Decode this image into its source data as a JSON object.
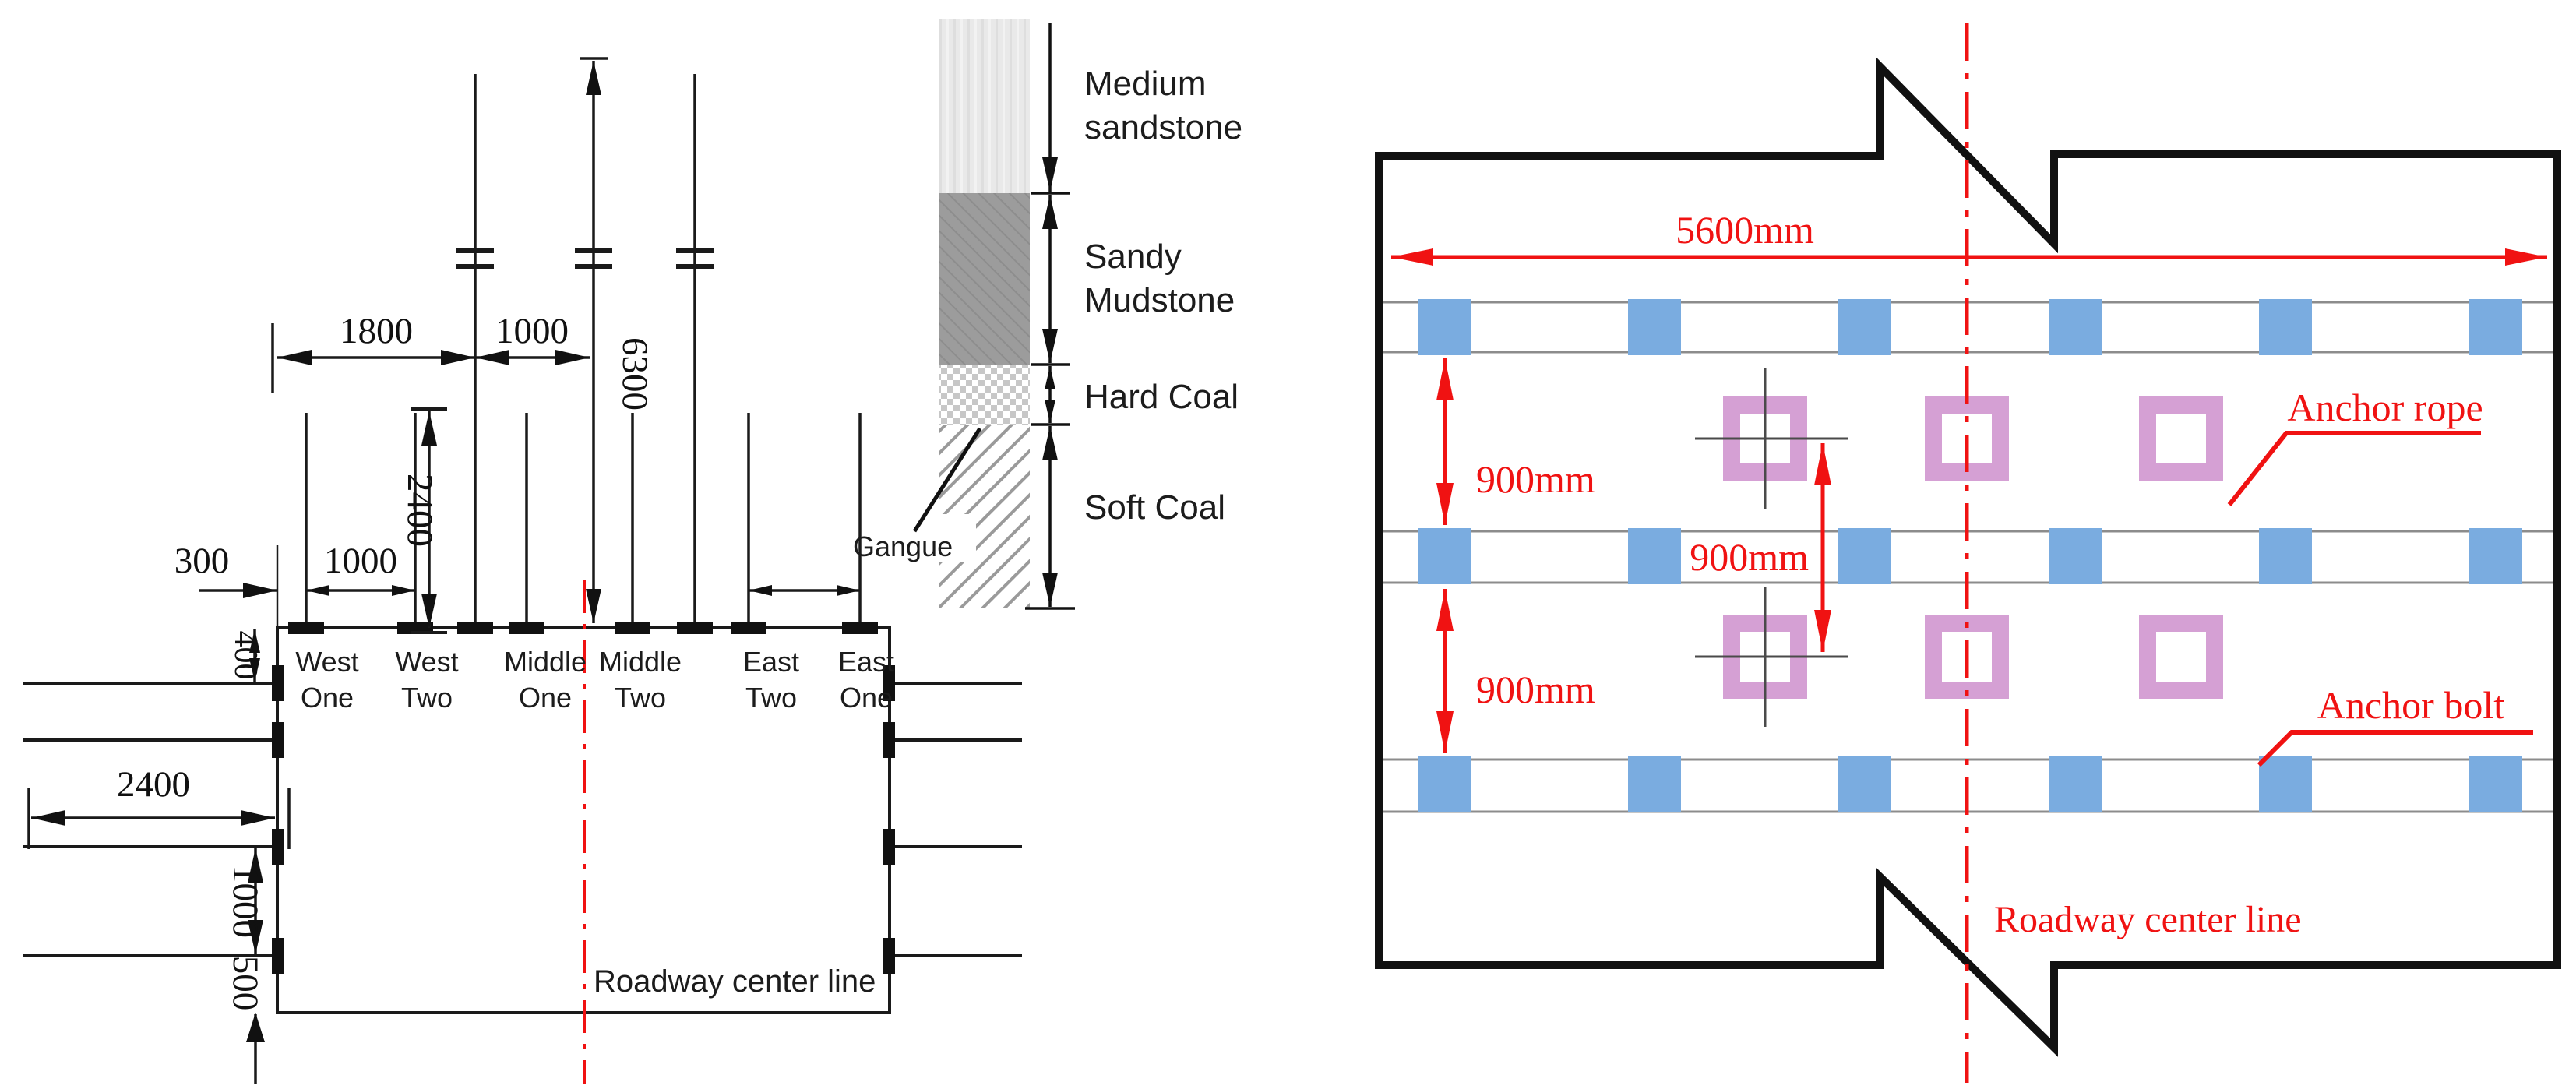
{
  "colors": {
    "accent_red": "#f01212",
    "bolt_blue": "#7aace0",
    "rope_pink": "#d5a0d4",
    "band_gray": "#8c8c8c",
    "sandstone_gray": "#e9e9e9",
    "mudstone_gray": "#9c9c9c"
  },
  "left": {
    "dim_1800": "1800",
    "dim_1000_top": "1000",
    "dim_6300": "6300",
    "dim_2400_vert": "2400",
    "dim_300": "300",
    "dim_400": "400",
    "dim_1000_row": "1000",
    "dim_2400_side": "2400",
    "dim_1000_side": "1000",
    "dim_500": "500",
    "bolts": [
      {
        "line1": "West",
        "line2": "One"
      },
      {
        "line1": "West",
        "line2": "Two"
      },
      {
        "line1": "Middle",
        "line2": "One"
      },
      {
        "line1": "Middle",
        "line2": "Two"
      },
      {
        "line1": "East",
        "line2": "Two"
      },
      {
        "line1": "East",
        "line2": "One"
      }
    ],
    "centerline_label": "Roadway center line"
  },
  "strat": {
    "layers": [
      {
        "l1": "Medium",
        "l2": "sandstone"
      },
      {
        "l1": "Sandy",
        "l2": "Mudstone"
      },
      {
        "l1": "Hard Coal",
        "l2": ""
      },
      {
        "l1": "Soft Coal",
        "l2": ""
      }
    ],
    "gangue": "Gangue"
  },
  "right": {
    "dim_width": "5600mm",
    "dim_row1": "900mm",
    "dim_row2": "900mm",
    "dim_rope": "900mm",
    "anchor_rope": "Anchor rope",
    "anchor_bolt": "Anchor bolt",
    "centerline_label": "Roadway center line"
  }
}
